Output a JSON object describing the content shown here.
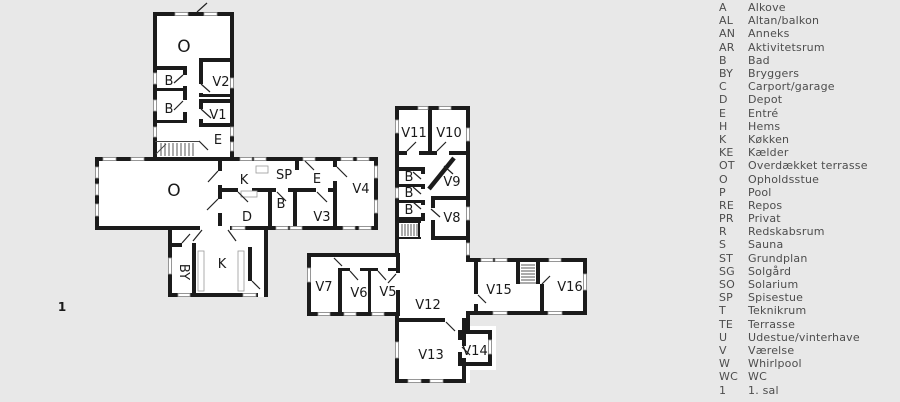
{
  "plan": {
    "floor_marker": "1",
    "upper_floor": {
      "o": "O",
      "b1": "B",
      "b2": "B",
      "v2": "V2",
      "v1": "V1",
      "e": "E"
    },
    "ground_floor": {
      "o": "O",
      "k": "K",
      "sp": "SP",
      "e": "E",
      "v4": "V4",
      "b": "B",
      "d": "D",
      "v3": "V3",
      "by": "BY",
      "k2": "K"
    },
    "wing": {
      "v11": "V11",
      "v10": "V10",
      "b1": "B",
      "b2": "B",
      "b3": "B",
      "v9": "V9",
      "v8": "V8"
    },
    "south_wing": {
      "v7": "V7",
      "v6": "V6",
      "v5": "V5",
      "v12": "V12",
      "v13": "V13",
      "v14": "V14",
      "v15": "V15",
      "v16": "V16"
    }
  },
  "legend": {
    "items": [
      {
        "abbr": "A",
        "label": "Alkove"
      },
      {
        "abbr": "AL",
        "label": "Altan/balkon"
      },
      {
        "abbr": "AN",
        "label": "Anneks"
      },
      {
        "abbr": "AR",
        "label": "Aktivitetsrum"
      },
      {
        "abbr": "B",
        "label": "Bad"
      },
      {
        "abbr": "BY",
        "label": "Bryggers"
      },
      {
        "abbr": "C",
        "label": "Carport/garage"
      },
      {
        "abbr": "D",
        "label": "Depot"
      },
      {
        "abbr": "E",
        "label": "Entré"
      },
      {
        "abbr": "H",
        "label": "Hems"
      },
      {
        "abbr": "K",
        "label": "Køkken"
      },
      {
        "abbr": "KE",
        "label": "Kælder"
      },
      {
        "abbr": "OT",
        "label": "Overdækket terrasse"
      },
      {
        "abbr": "O",
        "label": "Opholdsstue"
      },
      {
        "abbr": "P",
        "label": "Pool"
      },
      {
        "abbr": "RE",
        "label": "Repos"
      },
      {
        "abbr": "PR",
        "label": "Privat"
      },
      {
        "abbr": "R",
        "label": "Redskabsrum"
      },
      {
        "abbr": "S",
        "label": "Sauna"
      },
      {
        "abbr": "ST",
        "label": "Grundplan"
      },
      {
        "abbr": "SG",
        "label": "Solgård"
      },
      {
        "abbr": "SO",
        "label": "Solarium"
      },
      {
        "abbr": "SP",
        "label": "Spisestue"
      },
      {
        "abbr": "T",
        "label": "Teknikrum"
      },
      {
        "abbr": "TE",
        "label": "Terrasse"
      },
      {
        "abbr": "U",
        "label": "Udestue/vinterhave"
      },
      {
        "abbr": "V",
        "label": "Værelse"
      },
      {
        "abbr": "W",
        "label": "Whirlpool"
      },
      {
        "abbr": "WC",
        "label": "WC"
      },
      {
        "abbr": "1",
        "label": "1. sal"
      }
    ]
  },
  "colors": {
    "background": "#e8e8e8",
    "wall": "#1b1b1b",
    "floor": "#ffffff",
    "legend_text": "#4d4d4d"
  }
}
